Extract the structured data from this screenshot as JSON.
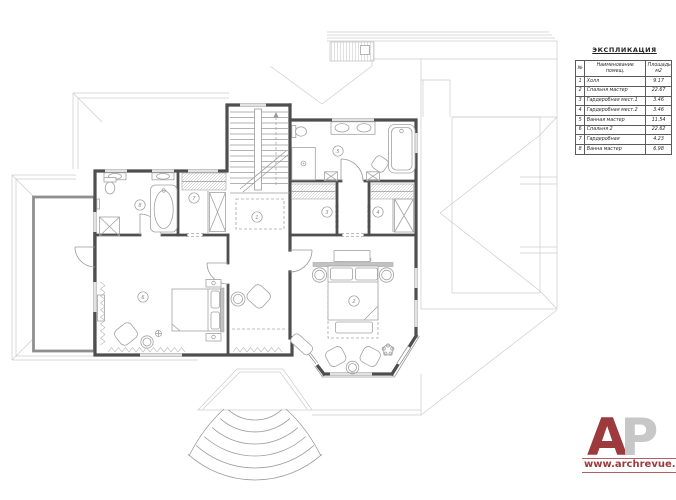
{
  "legend": {
    "title": "ЭКСПЛИКАЦИЯ",
    "columns": [
      "№",
      "Наименование помещ.",
      "Площадь м2"
    ],
    "rows": [
      [
        "1",
        "Холл",
        "9.17"
      ],
      [
        "2",
        "Спальня мастер",
        "22.67"
      ],
      [
        "3",
        "Гардеробная мест.1",
        "3.46"
      ],
      [
        "4",
        "Гардеробная мест.2",
        "3.46"
      ],
      [
        "5",
        "Ванная мастер",
        "11.54"
      ],
      [
        "6",
        "Спальня 2",
        "22.62"
      ],
      [
        "7",
        "Гардеробная",
        "4.23"
      ],
      [
        "8",
        "Ванна мастер",
        "6.98"
      ]
    ]
  },
  "plan": {
    "rooms": [
      {
        "num": "1",
        "label": "Холл",
        "x": 257,
        "y": 217
      },
      {
        "num": "2",
        "label": "Спальня мастер",
        "x": 354,
        "y": 301
      },
      {
        "num": "3",
        "label": "Гардеробная мест.1",
        "x": 327,
        "y": 212
      },
      {
        "num": "4",
        "label": "Гардеробная мест.2",
        "x": 378,
        "y": 212
      },
      {
        "num": "5",
        "label": "Ванная мастер",
        "x": 338,
        "y": 151
      },
      {
        "num": "6",
        "label": "Спальня 2",
        "x": 143,
        "y": 297
      },
      {
        "num": "7",
        "label": "Гардеробная",
        "x": 194,
        "y": 198
      },
      {
        "num": "8",
        "label": "Ванна мастер",
        "x": 140,
        "y": 205
      }
    ]
  },
  "branding": {
    "logo_letter_1": "А",
    "logo_letter_2": "Р",
    "site": "www.archrevue.ru",
    "accent_color": "#9c3a3e",
    "muted_color": "#c7c7c7"
  }
}
